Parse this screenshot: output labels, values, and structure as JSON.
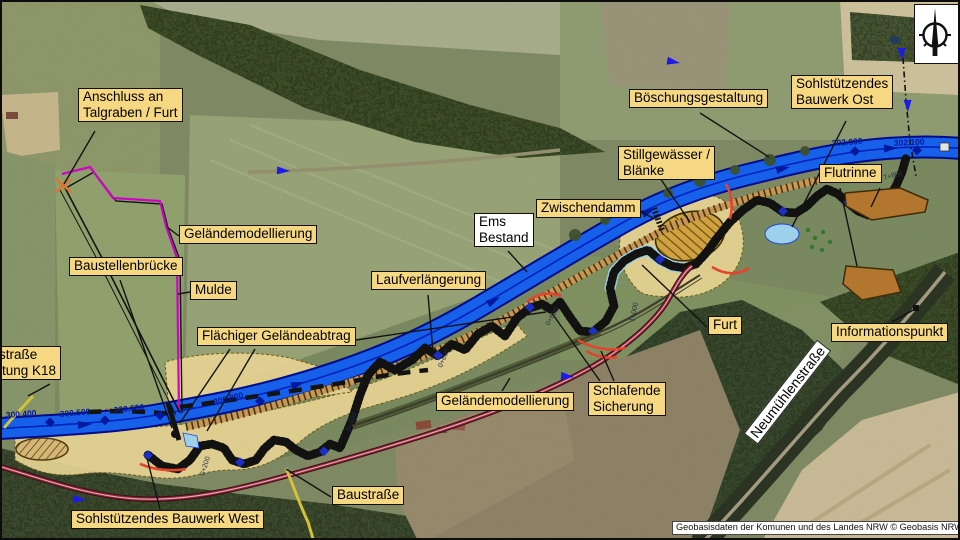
{
  "labels": {
    "anschluss": "Anschluss an\nTalgraben / Furt",
    "gelaendemodellierung_nw": "Geländemodellierung",
    "baustellenbruecke": "Baustellenbrücke",
    "mulde": "Mulde",
    "flaechiger_gelaendeabtrag": "Flächiger Geländeabtrag",
    "baustrasse_k18": "Baustraße\nRichtung K18",
    "sohlbauwerk_west": "Sohlstützendes Bauwerk West",
    "baustrasse": "Baustraße",
    "laufverlaengerung": "Laufverlängerung",
    "ems_bestand": "Ems\nBestand",
    "zwischendamm": "Zwischendamm",
    "gelaendemodellierung_s": "Geländemodellierung",
    "schlafende_sicherung": "Schlafende\nSicherung",
    "furt": "Furt",
    "stillgewaesser": "Stillgewässer /\nBlänke",
    "boeschungsgestaltung": "Böschungsgestaltung",
    "sohlbauwerk_ost": "Sohlstützendes\nBauwerk Ost",
    "flutrinne": "Flutrinne",
    "informationspunkt": "Informationspunkt",
    "neumuehlenstrasse": "Neumühlenstraße"
  },
  "stations": {
    "s1": "300.400",
    "s2": "300.500",
    "s3": "300.600",
    "s4": "300.800",
    "s5": "302.000",
    "s6": "302.100"
  },
  "chainage": {
    "c1": "0+200",
    "c2": "0+400",
    "c3": "0+600",
    "c4": "0+800",
    "c5": "1+000",
    "c6": "7+800"
  },
  "attribution": "Geobasisdaten der Komunen und des Landes NRW © Geobasis NRW 2022",
  "icons": {
    "north_arrow": "compass-north-needle"
  },
  "colors": {
    "label_bg": "#f6d883",
    "river": "#1560ee",
    "river_edge": "#000a8c",
    "river_center": "#0020c0",
    "channel": "#2243e0",
    "lightblue": "#9fd4ee",
    "tan_area": "#ead795",
    "magenta": "#d400c8",
    "road_maroon": "#8b2433",
    "road_maroon_core": "#e8a8b8",
    "road_yellow": "#d8c437",
    "red_marker": "#e6442e",
    "brown_poly": "#b5772e",
    "green_dots": "#2f7a2f"
  }
}
